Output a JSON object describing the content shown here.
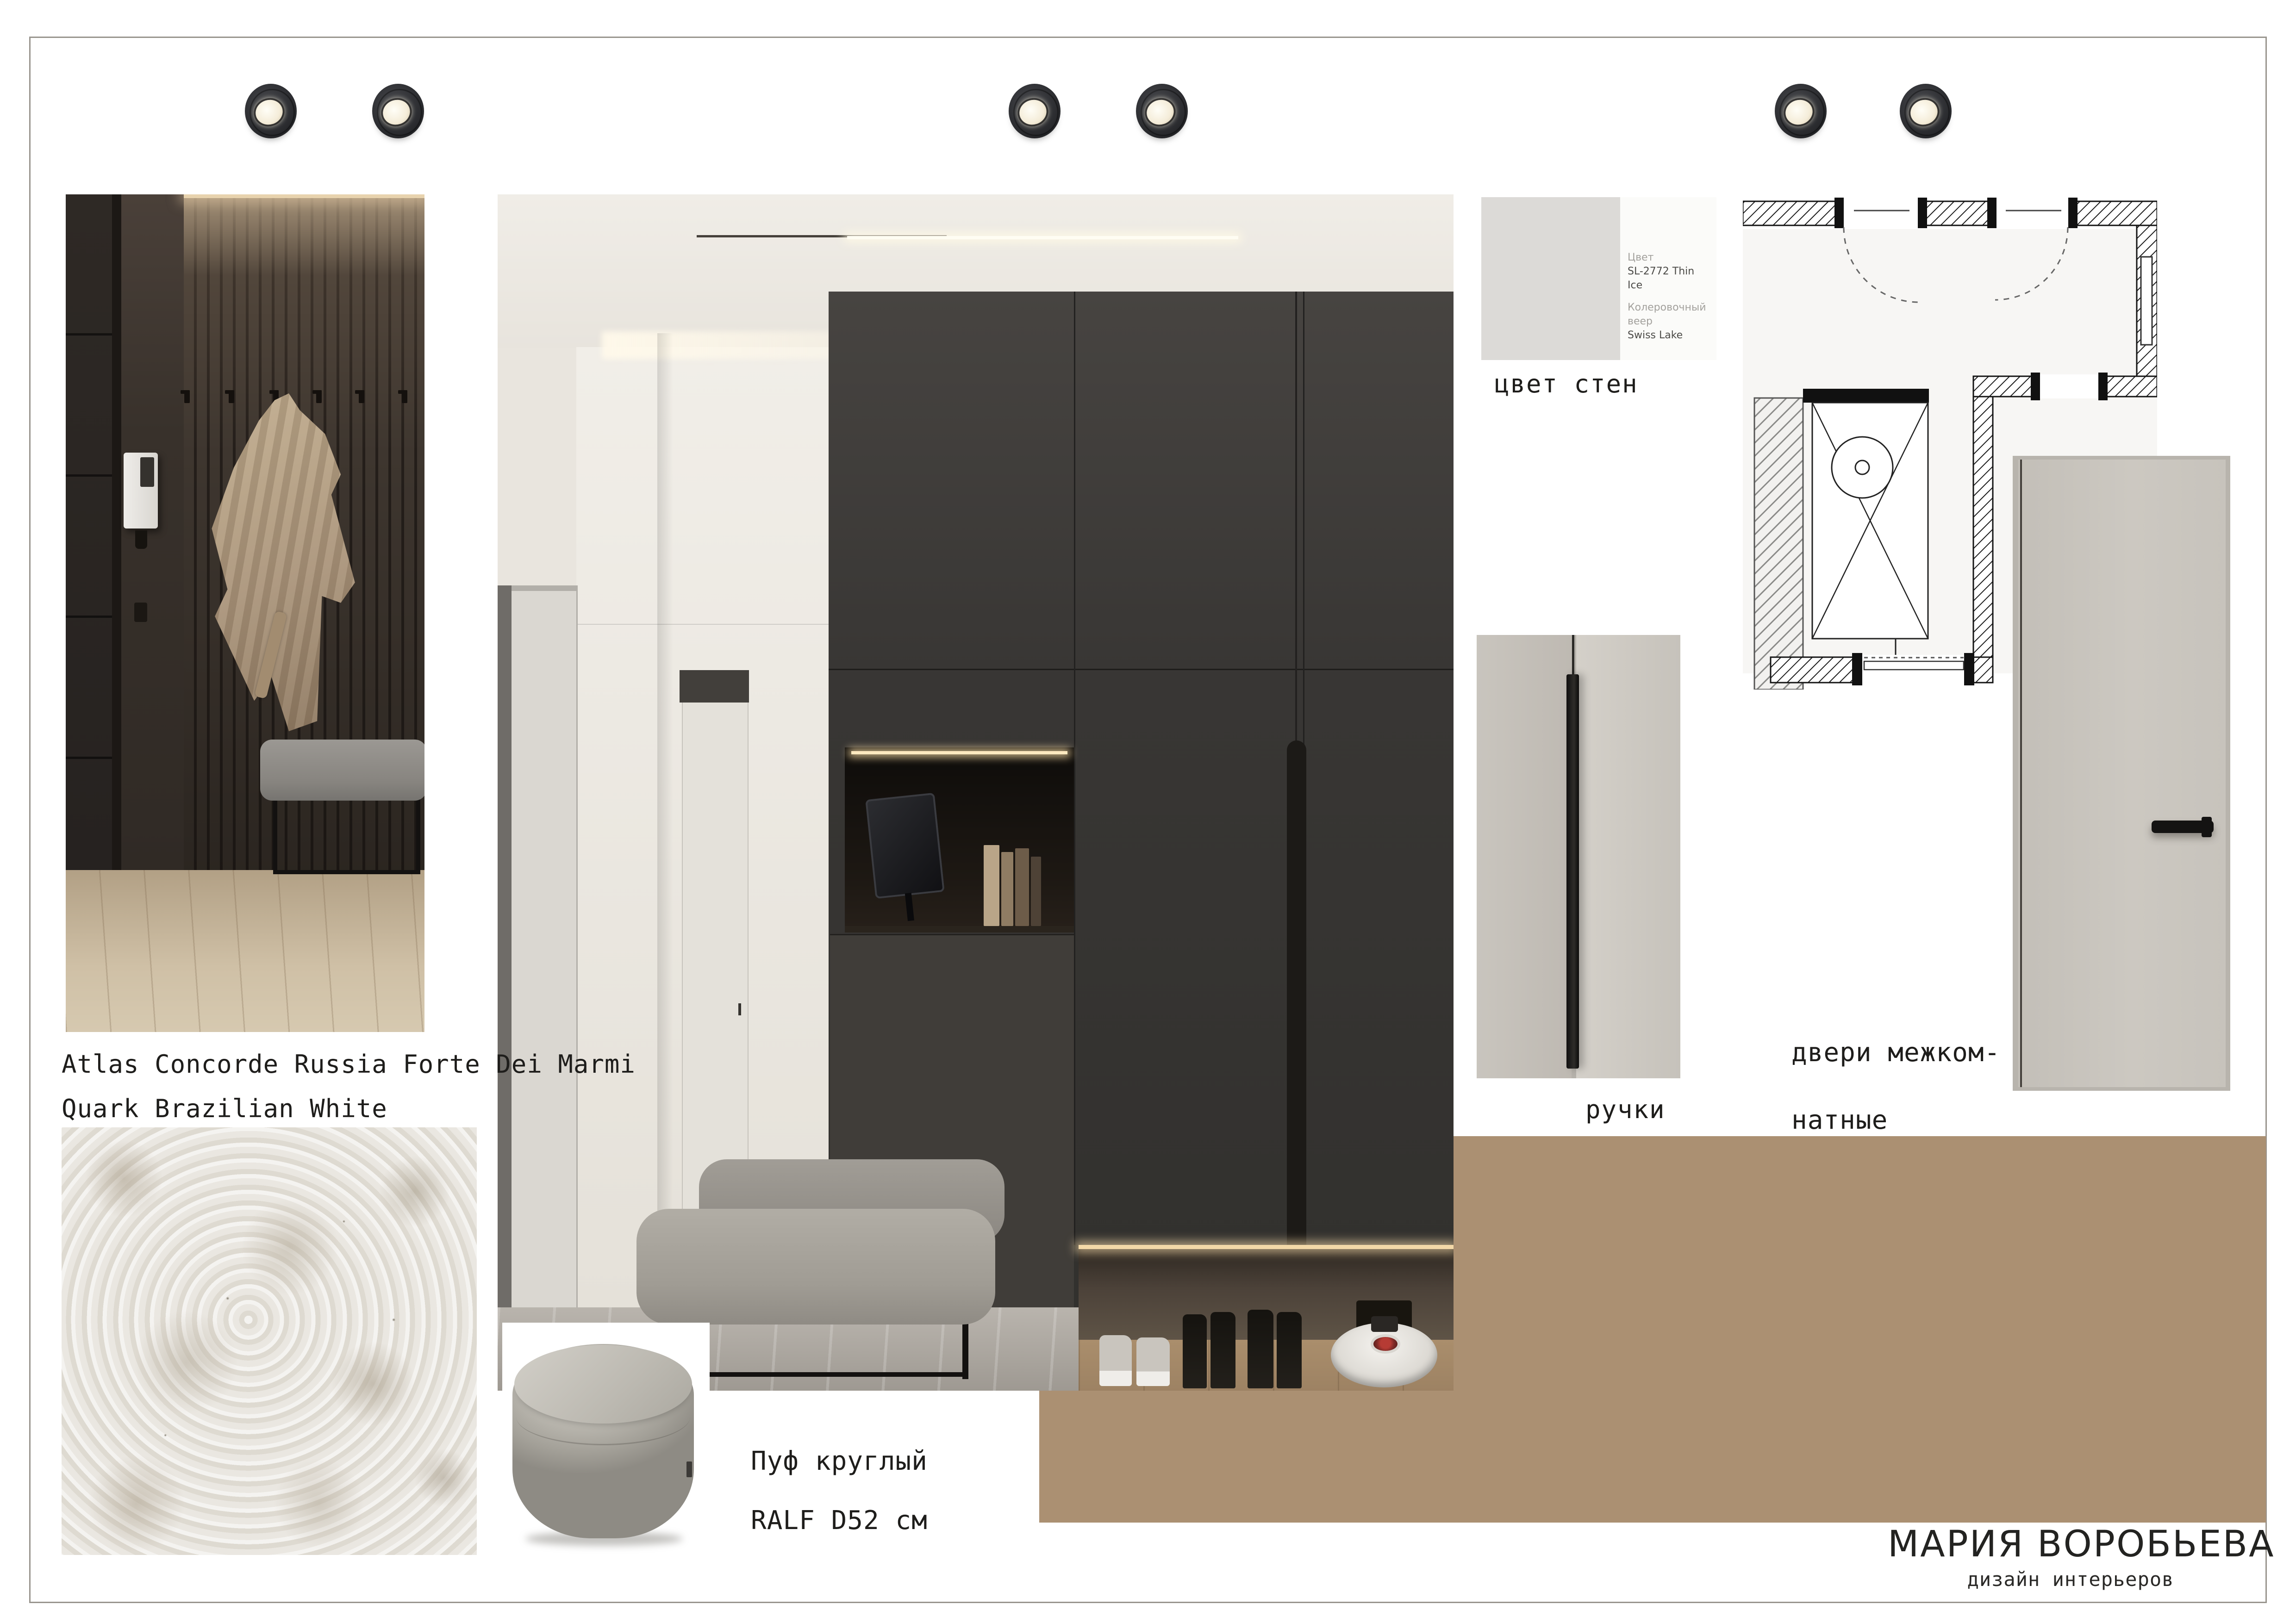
{
  "board": {
    "author": {
      "name": "МАРИЯ ВОРОБЬЕВА",
      "subtitle": "дизайн интерьеров"
    },
    "labels": {
      "marble_line1": "Atlas Concorde Russia Forte Dei Marmi",
      "marble_line2": "Quark Brazilian White",
      "wall_color": "цвет стен",
      "handles": "ручки",
      "doors_line1": "двери межком-",
      "doors_line2": "натные",
      "pouf_line1": "Пуф круглый",
      "pouf_line2": "RALF D52 см"
    },
    "paint_card": {
      "color_label": "Цвет",
      "color_value": "SL-2772 Thin Ice",
      "fan_label": "Колеровочный веер",
      "fan_value": "Swiss Lake",
      "swatch_color": "#dcdad7"
    },
    "palette": {
      "wood": "#ab9072",
      "graphite_wardrobe": "#37342f",
      "wall_cream": "#e9e5de",
      "door_greige": "#cac6bf",
      "marble_base": "#eae7e1",
      "accent_black": "#1c1a18"
    },
    "icons": [
      "spotlight-image"
    ]
  }
}
